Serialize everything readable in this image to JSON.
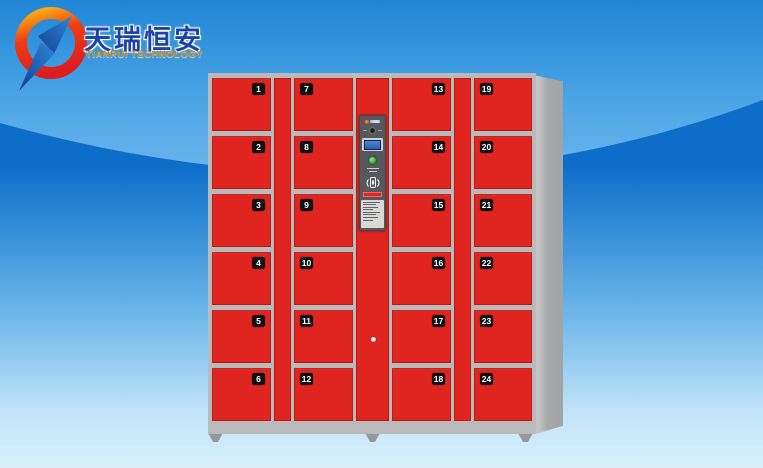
{
  "page": {
    "background_top": "#1f86d6",
    "background_bottom": "#d8effb",
    "wave_blue": "#0d6ec9"
  },
  "brand": {
    "name_cn": "天瑞恒安",
    "name_en": "TIANRUI TECHNOLOGY",
    "cn": "#1c44a8",
    "en": "#c8860e"
  },
  "locker": {
    "columns": [
      {
        "position": "left-outer",
        "number_side": "right",
        "doors": [
          "1",
          "2",
          "3",
          "4",
          "5",
          "6"
        ]
      },
      {
        "position": "left-inner",
        "number_side": "left",
        "doors": [
          "7",
          "8",
          "9",
          "10",
          "11",
          "12"
        ]
      },
      {
        "position": "right-inner",
        "number_side": "right",
        "doors": [
          "13",
          "14",
          "15",
          "16",
          "17",
          "18"
        ]
      },
      {
        "position": "right-outer",
        "number_side": "left",
        "doors": [
          "19",
          "20",
          "21",
          "22",
          "23",
          "24"
        ]
      }
    ],
    "panel": {
      "icons": [
        "brand-mark",
        "keyhole-eye",
        "lcd-screen",
        "green-led",
        "card-reader-icon",
        "red-button",
        "instruction-label"
      ]
    },
    "colors": {
      "door_red": "#e02420",
      "frame_gray": "#b9babc",
      "side_gray": "#a8a9ab",
      "panel_gray": "#57585b",
      "led_green": "#2fbf2f"
    }
  }
}
